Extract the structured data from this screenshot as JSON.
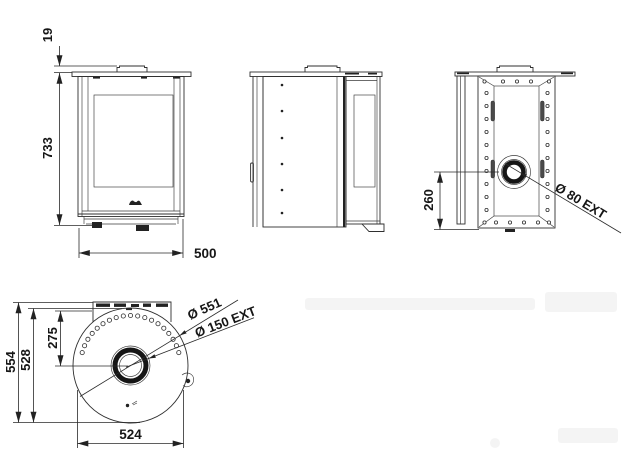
{
  "drawing": {
    "colors": {
      "line": "#2f2f2f",
      "text": "#161616",
      "background": "#ffffff"
    },
    "front_view": {
      "height": "733",
      "collar_height": "19",
      "width": "500"
    },
    "rear_view": {
      "inlet_center_height": "260",
      "inlet_diameter": "Ø 80 EXT"
    },
    "top_view": {
      "overall_depth": "554",
      "body_depth": "528",
      "flue_setback": "275",
      "body_width": "524",
      "top_plate_diameter": "Ø 551",
      "flue_diameter": "Ø 150 EXT"
    }
  }
}
